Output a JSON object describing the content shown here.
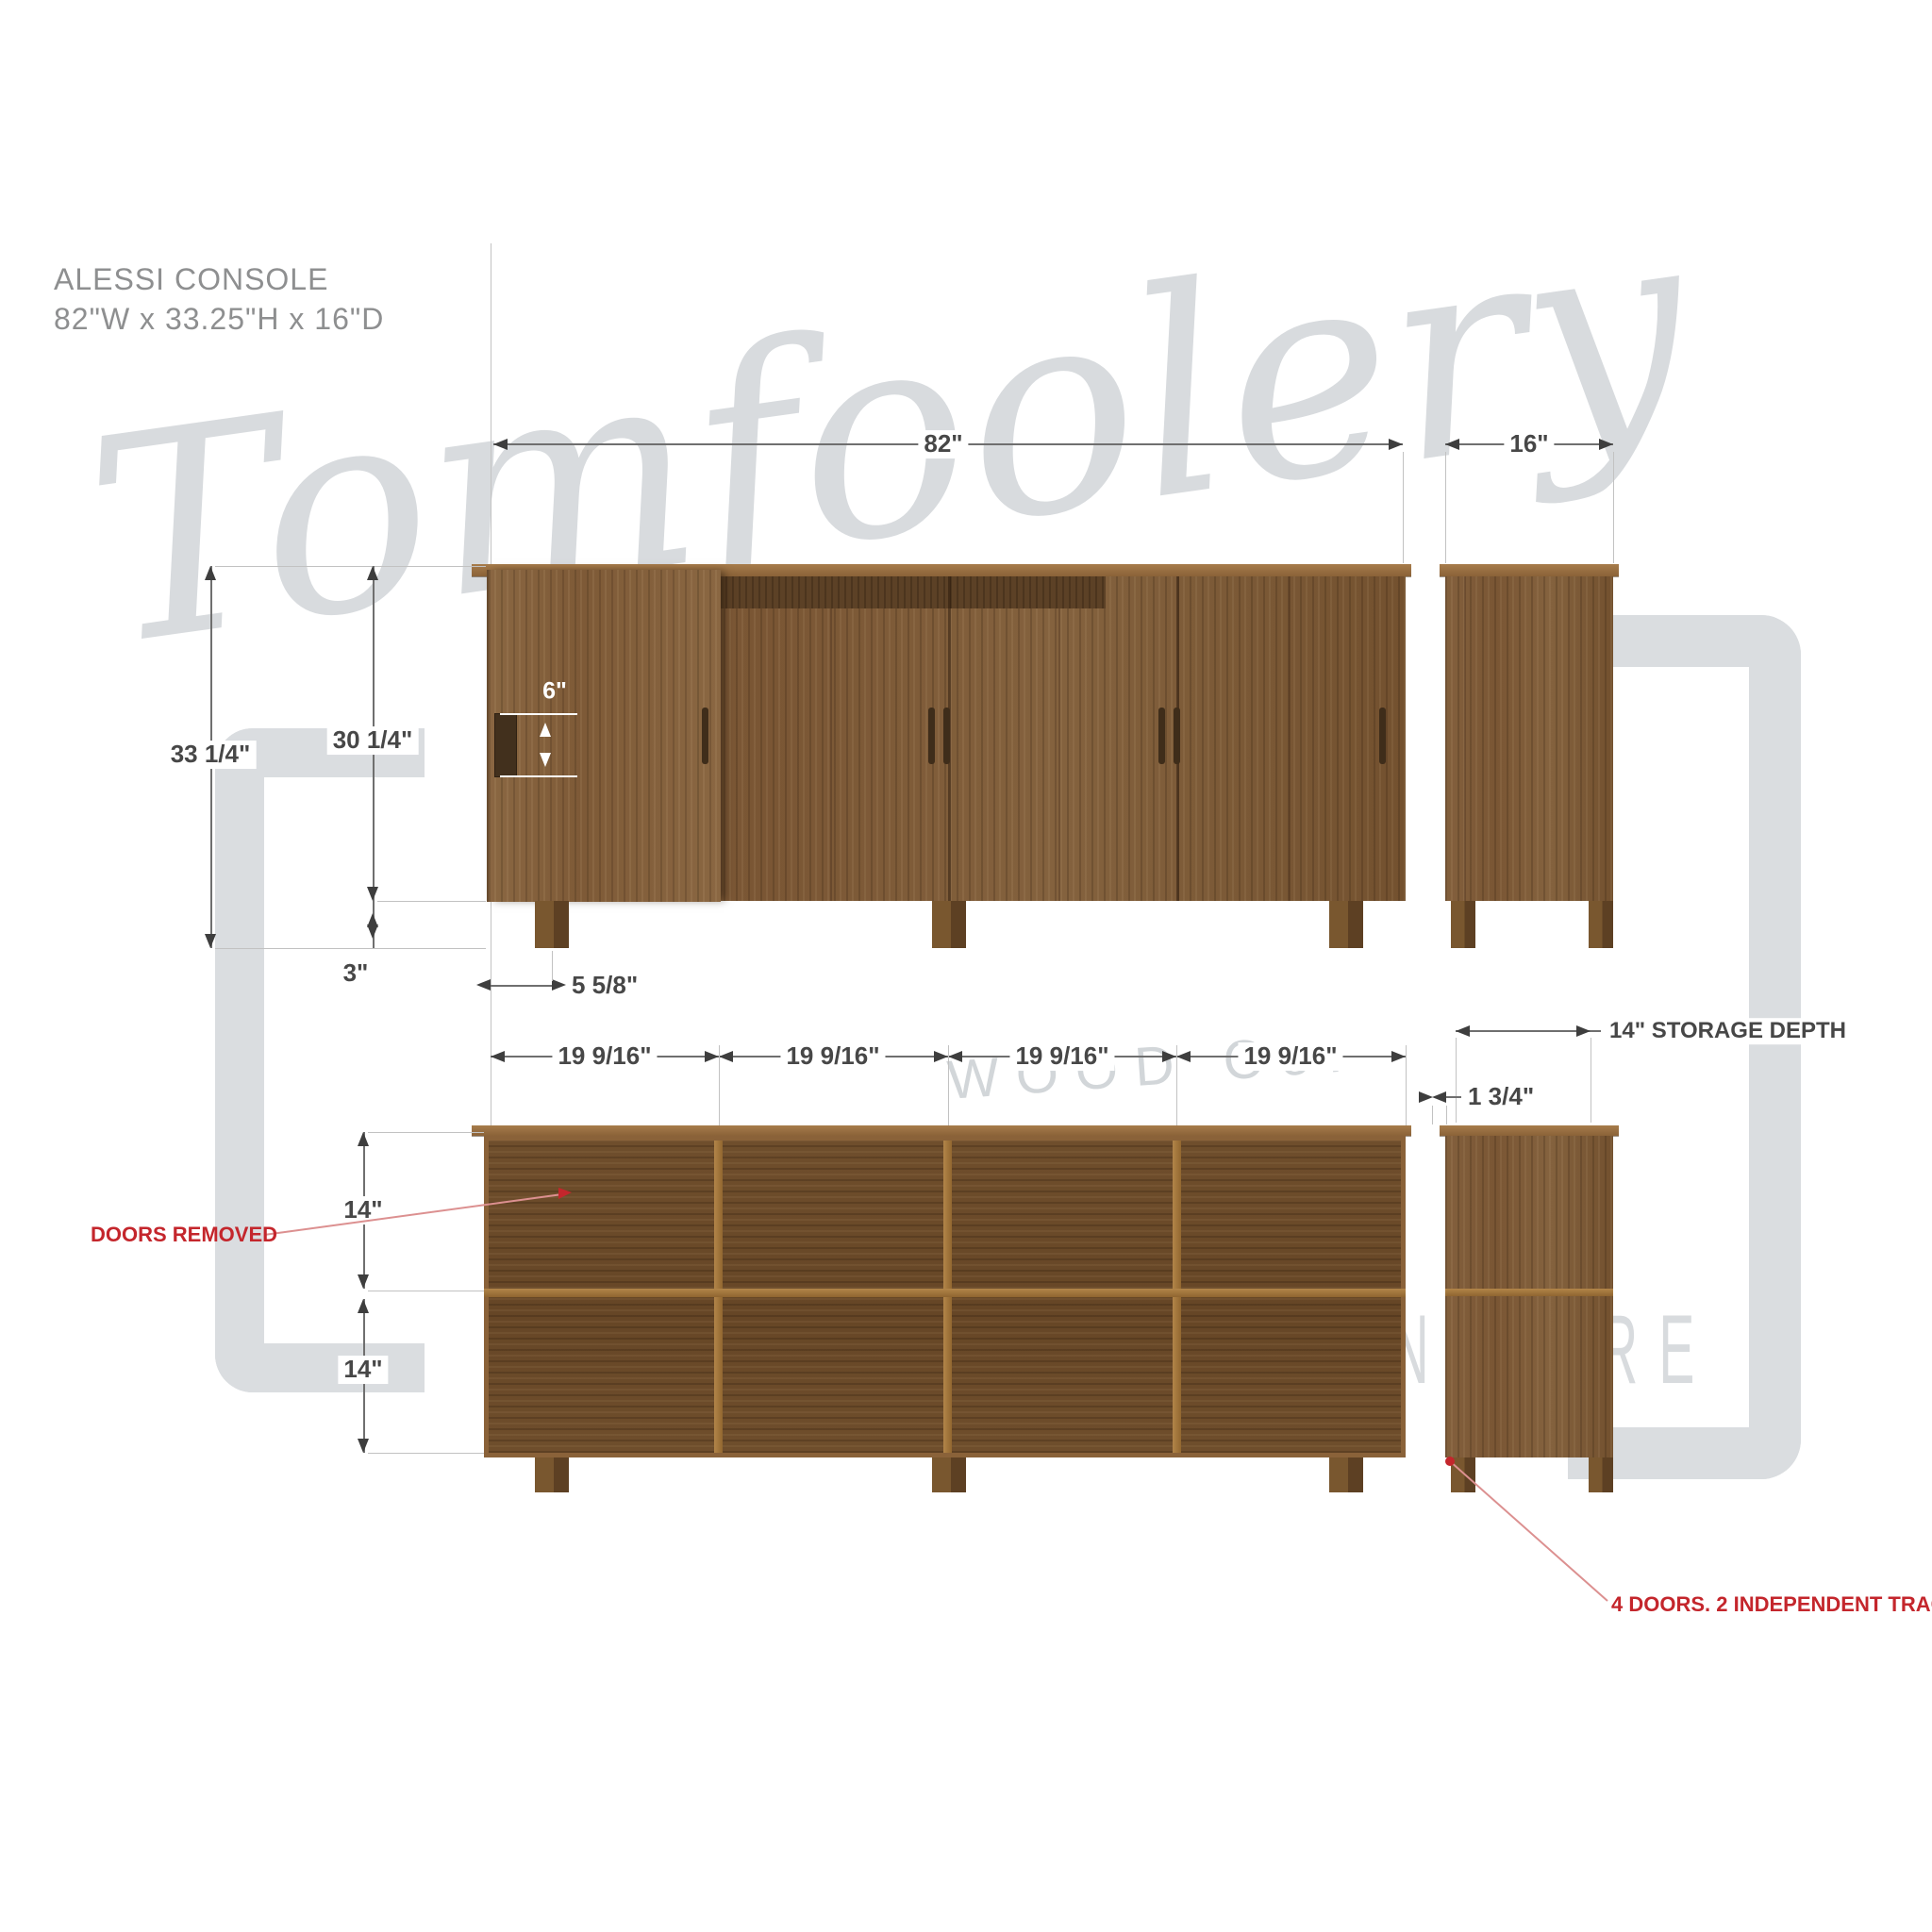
{
  "title": {
    "product": "ALESSI CONSOLE",
    "size": "82\"W x 33.25\"H x 16\"D"
  },
  "watermark": {
    "script": "Tomfoolery",
    "wood": "WOOD Co.",
    "furniture": "FURNITURE"
  },
  "dims": {
    "width": "82\"",
    "depth": "16\"",
    "height_total": "33 1/4\"",
    "height_case": "30 1/4\"",
    "leg_height": "3\"",
    "handle": "6\"",
    "leg_inset": "5 5/8\"",
    "bays": [
      "19 9/16\"",
      "19 9/16\"",
      "19 9/16\"",
      "19 9/16\""
    ],
    "shelf_upper": "14\"",
    "shelf_lower": "14\"",
    "storage_depth": "14\" STORAGE DEPTH",
    "panel_thickness": "1 3/4\""
  },
  "callouts": {
    "doors_removed": "DOORS REMOVED",
    "tracks": "4 DOORS. 2 INDEPENDENT TRACKS."
  },
  "colors": {
    "wood_mid": "#7d5a37",
    "wood_dark": "#5c4126",
    "wood_cap": "#a77c4b",
    "divider": "#a1763f",
    "dim_line": "#6f6f6f",
    "dim_text": "#474747",
    "accent_red": "#c4262c",
    "watermark_gray": "#d9dcdf",
    "title_gray": "#8e8f90"
  }
}
